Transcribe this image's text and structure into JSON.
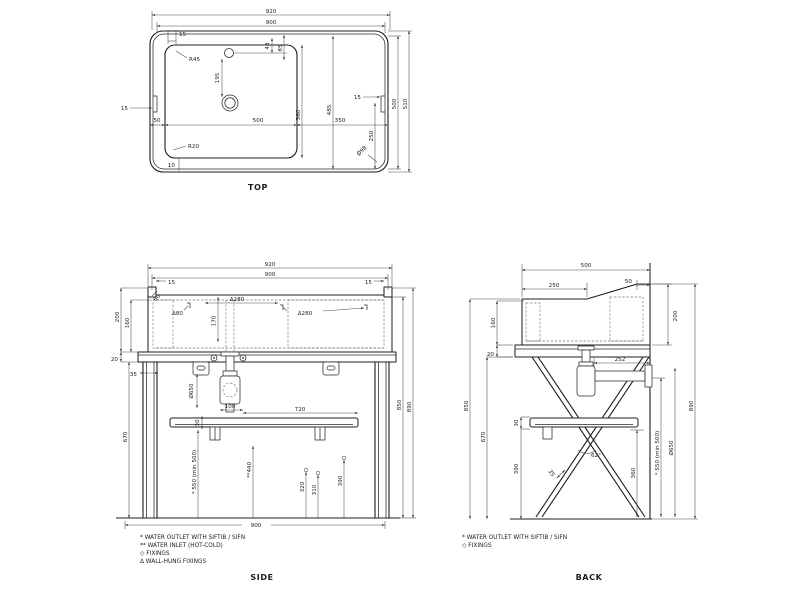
{
  "views": {
    "top": {
      "title": "TOP",
      "dims": {
        "overall_width": "920",
        "inner_width": "900",
        "edge_offset": "15",
        "bowl_left_margin": "50",
        "bowl_width": "500",
        "right_span": "350",
        "tap_offset_a": "43",
        "tap_offset_b": "85",
        "tap_to_drain": "195",
        "bowl_depth": "360",
        "inner_depth": "485",
        "right_offset": "250",
        "outer_depth": "500",
        "total_depth": "510",
        "corner_dia": "Ø98",
        "radius_top": "R45",
        "radius_bottom": "R20",
        "bottom_gap": "10"
      }
    },
    "side": {
      "title": "SIDE",
      "dims": {
        "overall_width": "920",
        "inner_width": "900",
        "edge_offset": "15",
        "rim_chamfer": "60",
        "wallfix_offset": "Δ80",
        "wallfix_pitch": "Δ280",
        "fix_depth": "170",
        "basin_height": "200",
        "basin_inner_depth": "160",
        "counter_thickness": "20",
        "leg_width": "35",
        "trap_hose": "Ø650",
        "trap_width": "100",
        "shelf_length": "720",
        "shelf_thickness": "30",
        "shelf_height": "670",
        "outlet_height": "* 550 (min 500)",
        "inlet_height": "**440",
        "dim_320": "320",
        "dim_310": "310",
        "dim_390": "390",
        "frame_height": "850",
        "total_height": "890",
        "base_width": "900"
      },
      "notes": [
        "*  WATER OUTLET WITH SIFTIB / SIFN",
        "** WATER INLET  (HOT-COLD)",
        "◇ FIXINGS",
        "Δ WALL-HUNG FIXINGS"
      ]
    },
    "back": {
      "title": "BACK",
      "dims": {
        "overall_depth": "500",
        "top_flat": "250",
        "wall_gap": "50",
        "basin_inner_depth": "160",
        "counter_gap": "20",
        "basin_height": "200",
        "trap_to_wall": "252",
        "frame_height": "850",
        "shelf_height": "670",
        "shelf_thickness": "30",
        "dim_390": "390",
        "angle": "62°",
        "leg_width": "35",
        "dim_360": "360",
        "outlet_height": "* 550 (min 500)",
        "trap_hose": "Ø650",
        "total_height": "890"
      },
      "notes": [
        "*  WATER OUTLET WITH SIFTIB / SIFN",
        "◇ FIXINGS"
      ]
    }
  }
}
